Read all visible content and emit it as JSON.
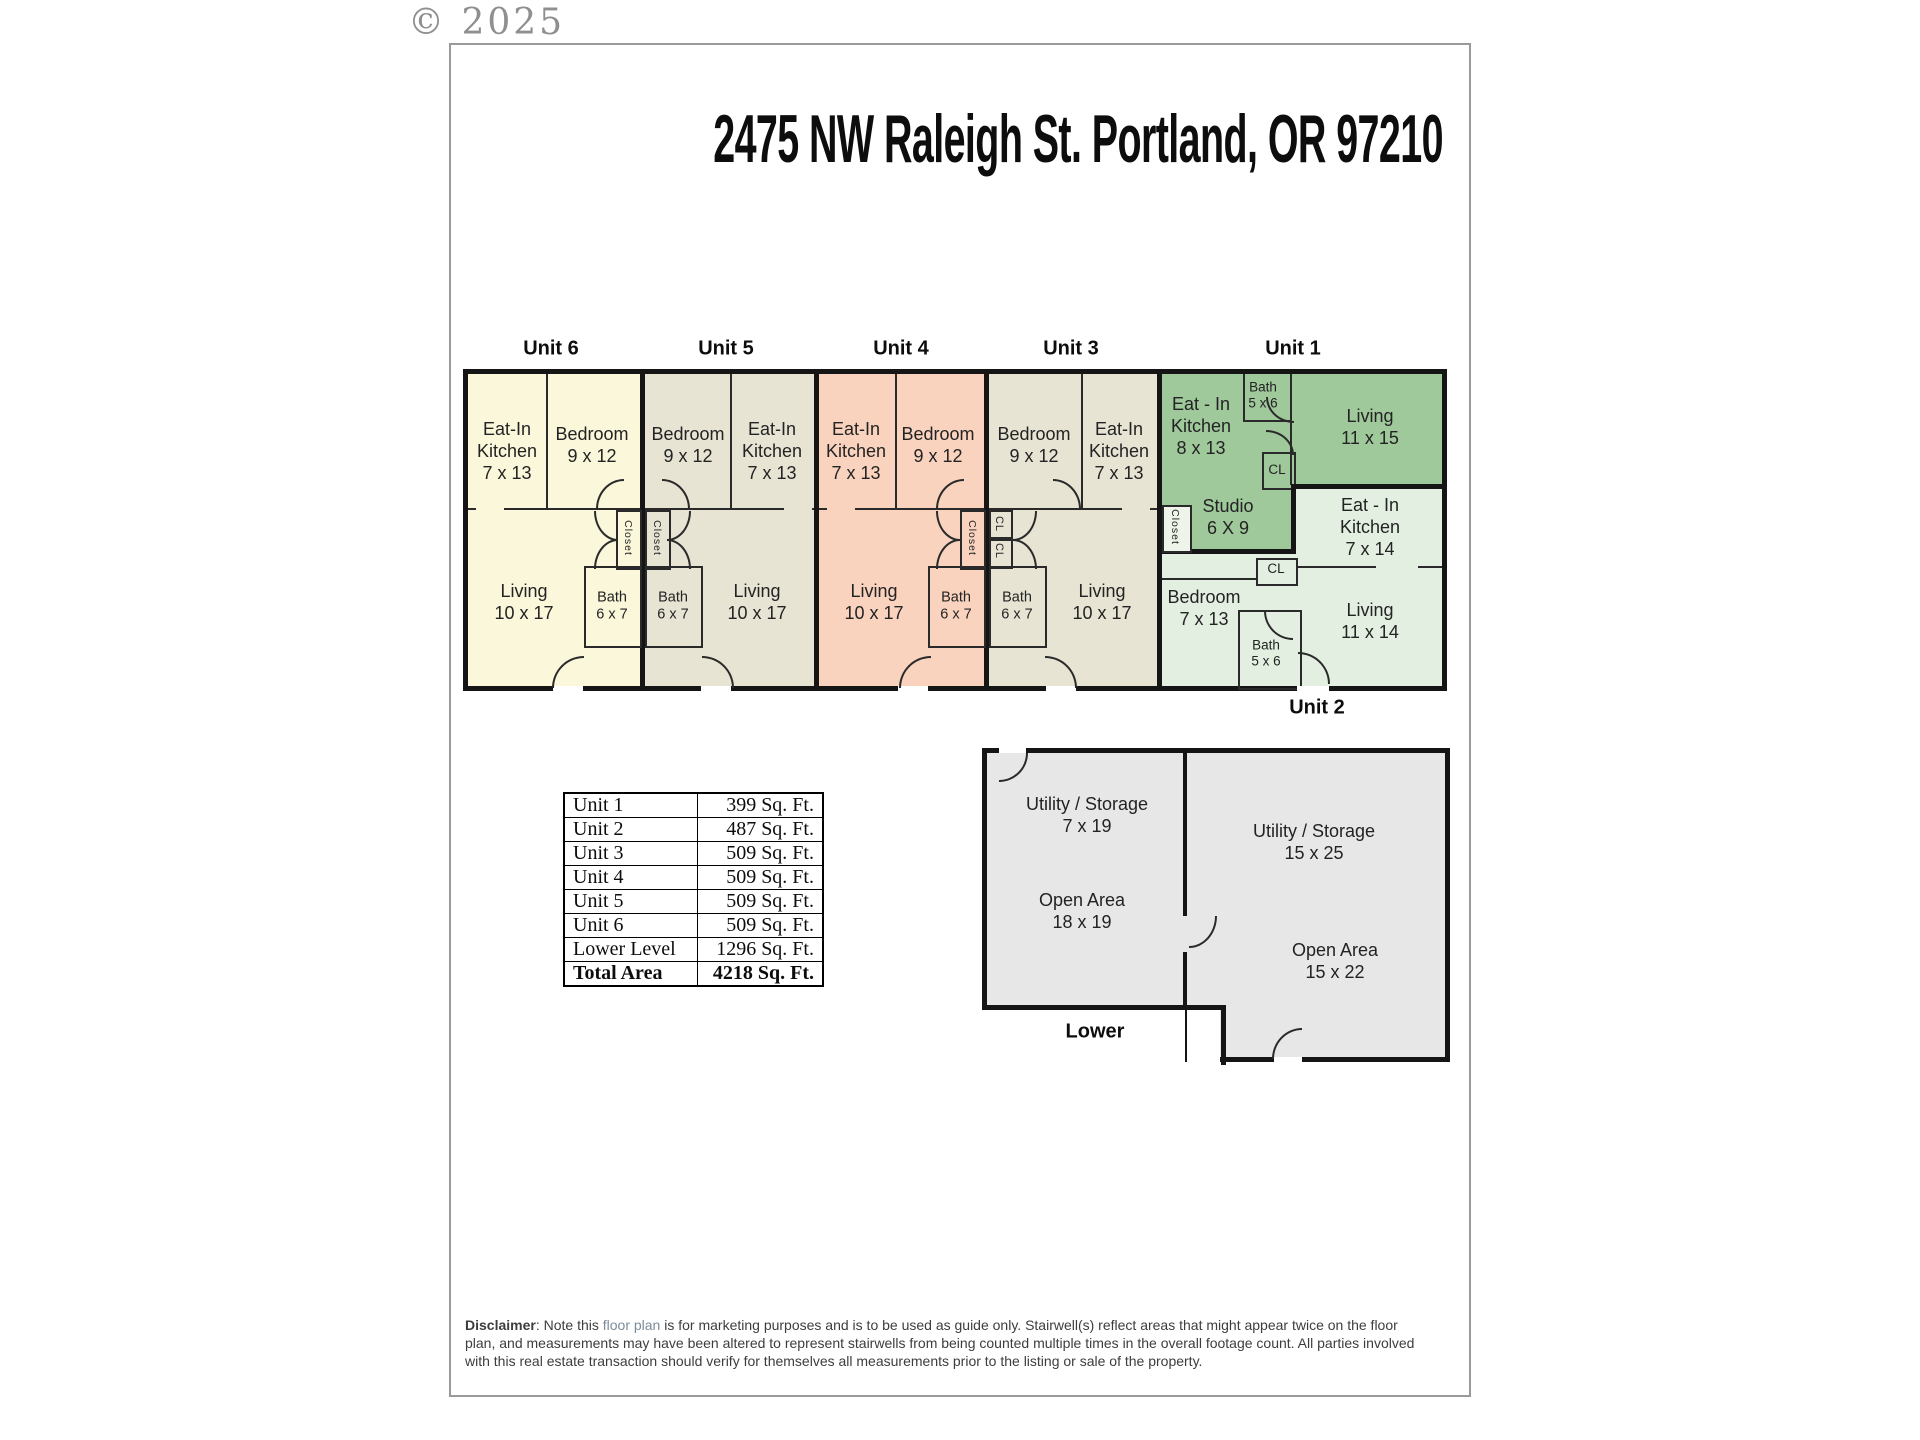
{
  "copyright": "© 2025",
  "title": "2475 NW Raleigh St. Portland, OR 97210",
  "units": {
    "unit6": {
      "label": "Unit 6",
      "kitchen": "Eat-In\nKitchen\n7 x 13",
      "bedroom": "Bedroom\n9 x 12",
      "living": "Living\n10 x 17",
      "bath": "Bath\n6 x 7",
      "closet": "Closet"
    },
    "unit5": {
      "label": "Unit 5",
      "kitchen": "Eat-In\nKitchen\n7 x 13",
      "bedroom": "Bedroom\n9 x 12",
      "living": "Living\n10 x 17",
      "bath": "Bath\n6 x 7",
      "closet": "Closet"
    },
    "unit4": {
      "label": "Unit 4",
      "kitchen": "Eat-In\nKitchen\n7 x 13",
      "bedroom": "Bedroom\n9 x 12",
      "living": "Living\n10 x 17",
      "bath": "Bath\n6 x 7",
      "closet": "Closet"
    },
    "unit3": {
      "label": "Unit 3",
      "kitchen": "Eat-In\nKitchen\n7 x 13",
      "bedroom": "Bedroom\n9 x 12",
      "living": "Living\n10 x 17",
      "bath": "Bath\n6 x 7",
      "cl_upper": "CL",
      "cl_lower": "CL"
    },
    "unit1": {
      "label": "Unit 1",
      "kitchen": "Eat - In\nKitchen\n8 x 13",
      "bath": "Bath\n5 x 6",
      "living": "Living\n11 x 15",
      "cl": "CL",
      "studio": "Studio\n6 X 9",
      "closet": "Closet"
    },
    "unit2": {
      "label": "Unit 2",
      "kitchen": "Eat - In\nKitchen\n7 x 14",
      "cl": "CL",
      "bedroom": "Bedroom\n7 x 13",
      "living": "Living\n11 x 14",
      "bath": "Bath\n5 x 6"
    }
  },
  "area_table": {
    "rows": [
      {
        "name": "Unit 1",
        "area": "399 Sq. Ft."
      },
      {
        "name": "Unit 2",
        "area": "487 Sq. Ft."
      },
      {
        "name": "Unit 3",
        "area": "509 Sq. Ft."
      },
      {
        "name": "Unit 4",
        "area": "509 Sq. Ft."
      },
      {
        "name": "Unit 5",
        "area": "509 Sq. Ft."
      },
      {
        "name": "Unit 6",
        "area": "509 Sq. Ft."
      },
      {
        "name": "Lower Level",
        "area": "1296 Sq. Ft."
      },
      {
        "name": "Total Area",
        "area": "4218 Sq. Ft."
      }
    ]
  },
  "lower_level": {
    "label": "Lower",
    "left_storage": "Utility / Storage\n7 x 19",
    "left_open": "Open Area\n18 x 19",
    "right_storage": "Utility / Storage\n15 x 25",
    "right_open": "Open Area\n15 x 22"
  },
  "disclaimer": {
    "prefix": "Disclaimer",
    "body_before": ": Note this ",
    "link_text": "floor plan",
    "body_after": " is for marketing purposes and is to be used as guide only.  Stairwell(s) reflect areas that might appear twice on the floor\nplan, and measurements may have been altered to represent stairwells from being counted multiple times in the overall footage count.  All parties involved\nwith this real estate transaction should verify for themselves all measurements prior to the listing or sale of the property."
  },
  "colors": {
    "unit6_fill": "#FAF7DA",
    "unit5_fill": "#E7E4D4",
    "unit4_fill": "#FAD3BF",
    "unit3_fill": "#E7E4D4",
    "unit1_fill": "#9FC89B",
    "unit2_fill": "#E3F0E1",
    "unit1_closet_fill": "#EEF4EA",
    "lower_fill": "#E7E7E7",
    "wall": "#151515",
    "sheet_border": "#9A9A9A",
    "copyright_gray": "#8F8F8F"
  }
}
